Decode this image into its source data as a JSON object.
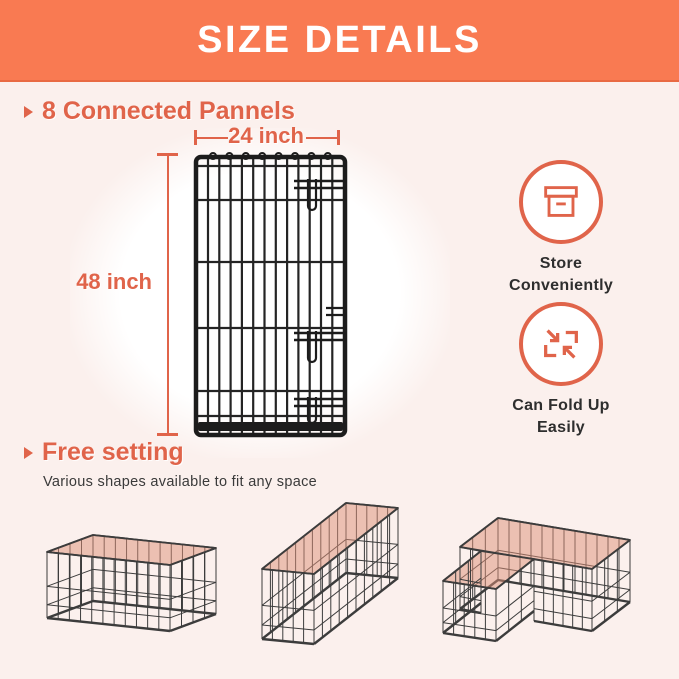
{
  "header": {
    "title": "SIZE DETAILS"
  },
  "colors": {
    "banner": "#F97A52",
    "accent": "#E0644A",
    "bg": "#FBF0ED",
    "wire": "#3C3C3C",
    "pen-fill": "#DD8F77"
  },
  "sections": {
    "panels": {
      "title": "8 Connected Pannels",
      "width_label": "24 inch",
      "height_label": "48 inch"
    },
    "free": {
      "title": "Free setting",
      "subtitle": "Various shapes available to fit any space"
    }
  },
  "features": [
    {
      "icon": "storage-box-icon",
      "line1": "Store",
      "line2": "Conveniently"
    },
    {
      "icon": "fold-arrows-icon",
      "line1": "Can Fold Up",
      "line2": "Easily"
    }
  ],
  "illustrations": [
    {
      "name": "wire-panel"
    },
    {
      "name": "square-pen"
    },
    {
      "name": "rectangle-pen"
    },
    {
      "name": "l-shape-pen"
    }
  ]
}
